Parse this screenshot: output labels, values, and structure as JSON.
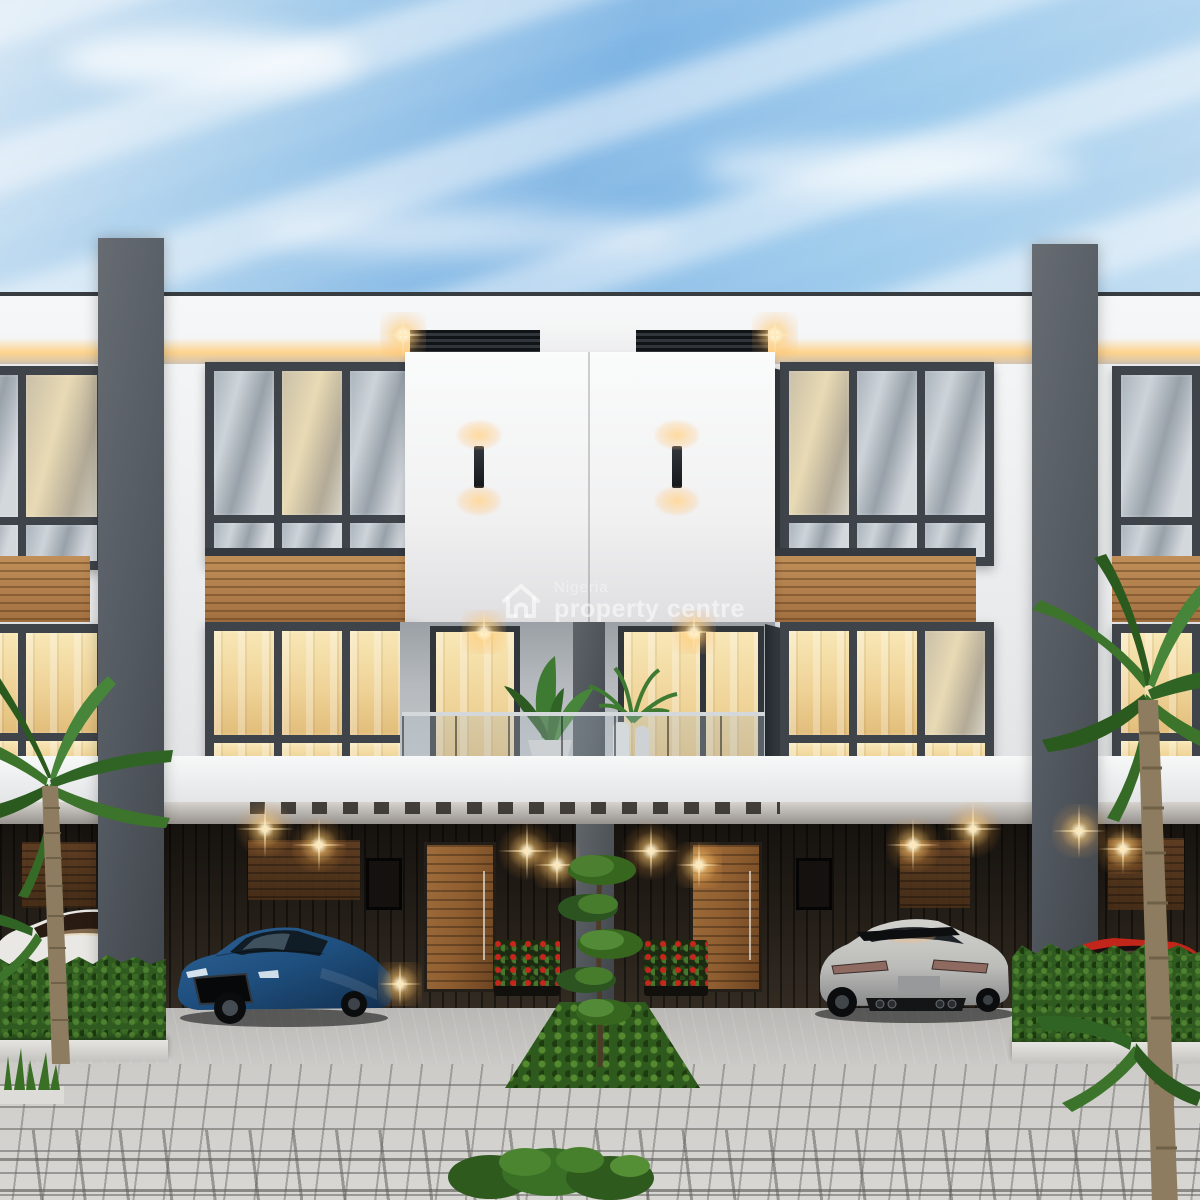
{
  "watermark": {
    "line1": "Nigeria",
    "line2": "property centre",
    "icon": "house-outline-icon"
  },
  "scene": {
    "type": "3d-architectural-rendering",
    "subject": "modern three-storey terraced duplex facade at dusk with lit interiors, carport, parked cars, palms and paved driveway",
    "objects": [
      "blue-sky-with-streaky-clouds",
      "white-parapet-with-warm-cove-lighting",
      "dark-framed-bay-windows",
      "wood-slat-cladding-bands",
      "central-white-panel-with-two-wall-sconces",
      "glass-balcony-railing-with-potted-plants",
      "recessed-carport-with-warm-downlights",
      "wooden-entrance-doors",
      "red-flower-planters",
      "blue-sedan",
      "silver-fastback",
      "white-car-partial-left",
      "red-car-partial-right",
      "palm-trees",
      "clipped-hedges",
      "topiary-tree-on-green-strip",
      "cobblestone-driveway"
    ],
    "colors": {
      "sky": "#8fc2e9",
      "facade_white": "#f3f4f5",
      "frame_dark": "#3f444a",
      "wood": "#c08f59",
      "door_wood": "#8f5e30",
      "warm_light": "#ffd9a0",
      "pillar_gray": "#535960",
      "carport_dark": "#262019",
      "hedge_green": "#2f5a20",
      "concrete": "#cbcac7",
      "car_blue": "#1e4e7d",
      "car_silver": "#bcbcb9",
      "car_white": "#eae9e5",
      "car_red": "#c22519"
    }
  }
}
